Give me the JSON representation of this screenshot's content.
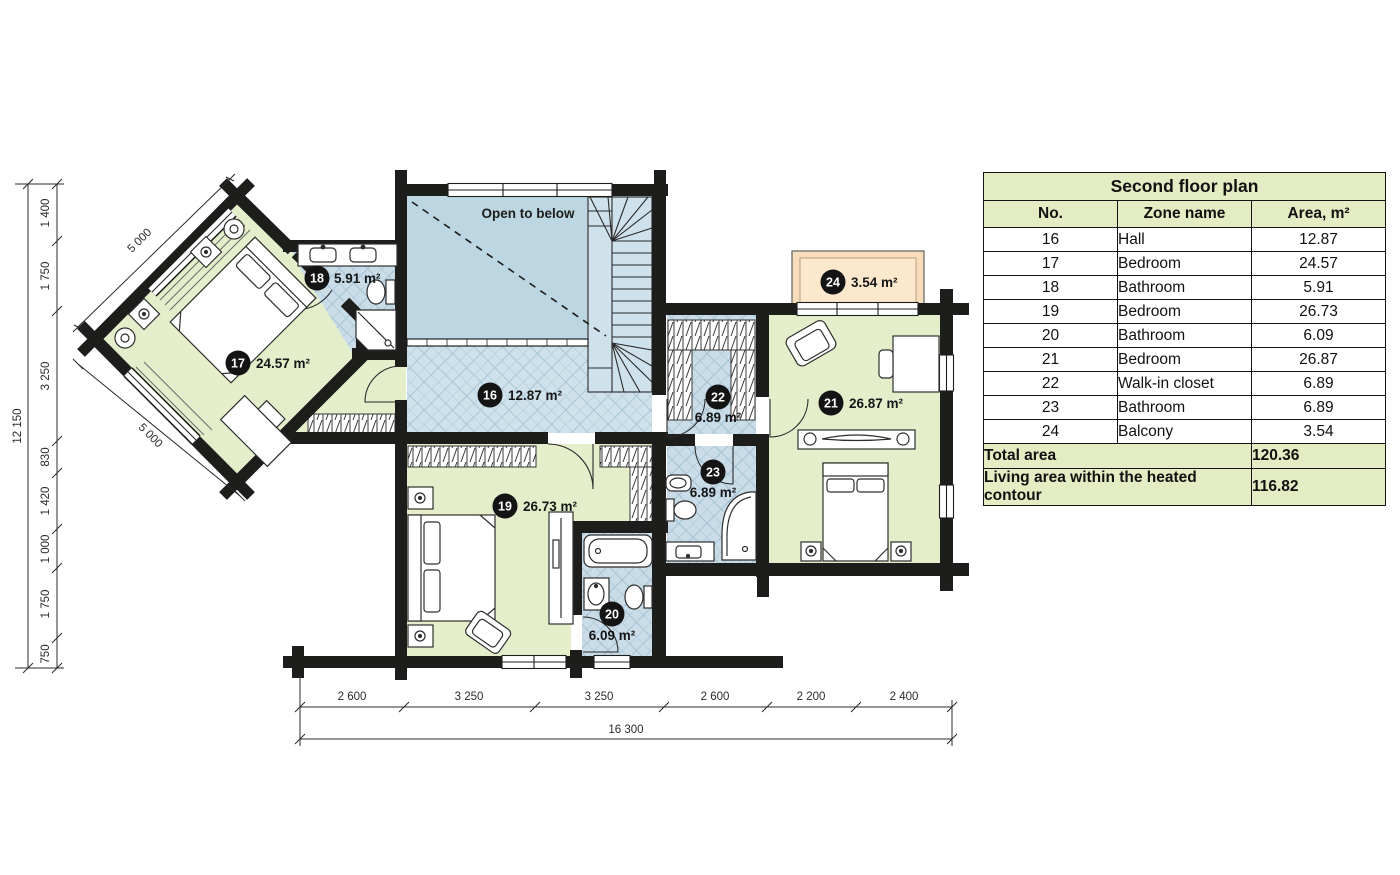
{
  "plan": {
    "open_to_below": "Open to below",
    "rooms": [
      {
        "no": "16",
        "name": "Hall",
        "area": "12.87 m²"
      },
      {
        "no": "17",
        "name": "Bedroom",
        "area": "24.57 m²"
      },
      {
        "no": "18",
        "name": "Bathroom",
        "area": "5.91 m²"
      },
      {
        "no": "19",
        "name": "Bedroom",
        "area": "26.73 m²"
      },
      {
        "no": "20",
        "name": "Bathroom",
        "area": "6.09 m²"
      },
      {
        "no": "21",
        "name": "Bedroom",
        "area": "26.87 m²"
      },
      {
        "no": "22",
        "name": "Walk-in closet",
        "area": "6.89 m²"
      },
      {
        "no": "23",
        "name": "Bathroom",
        "area": "6.89 m²"
      },
      {
        "no": "24",
        "name": "Balcony",
        "area": "3.54 m²"
      }
    ],
    "dimensions": {
      "left_total": "12 150",
      "left_segments": [
        "1 400",
        "1 750",
        "3 250",
        "830",
        "1 420",
        "1 000",
        "1 750",
        "750"
      ],
      "diagonal_top": "5 000",
      "diagonal_bottom": "5 000",
      "bottom_segments": [
        "2 600",
        "3 250",
        "3 250",
        "2 600",
        "2 200",
        "2 400"
      ],
      "bottom_total": "16 300"
    }
  },
  "table": {
    "title": "Second floor plan",
    "columns": [
      "No.",
      "Zone name",
      "Area, m²"
    ],
    "rows": [
      [
        "16",
        "Hall",
        "12.87"
      ],
      [
        "17",
        "Bedroom",
        "24.57"
      ],
      [
        "18",
        "Bathroom",
        "5.91"
      ],
      [
        "19",
        "Bedroom",
        "26.73"
      ],
      [
        "20",
        "Bathroom",
        "6.09"
      ],
      [
        "21",
        "Bedroom",
        "26.87"
      ],
      [
        "22",
        "Walk-in closet",
        "6.89"
      ],
      [
        "23",
        "Bathroom",
        "6.89"
      ],
      [
        "24",
        "Balcony",
        "3.54"
      ]
    ],
    "footer": [
      {
        "label": "Total area",
        "value": "120.36"
      },
      {
        "label": "Living area within the heated contour",
        "value": "116.82"
      }
    ]
  },
  "colors": {
    "wall": "#1d1d1b",
    "room_green": "#e4eecb",
    "room_blue": "#c9dce8",
    "hall_blue": "#cfe1eb",
    "open_blue": "#bcd6e2",
    "balcony": "#f9e0c0",
    "table_green": "#e3ecc2"
  }
}
